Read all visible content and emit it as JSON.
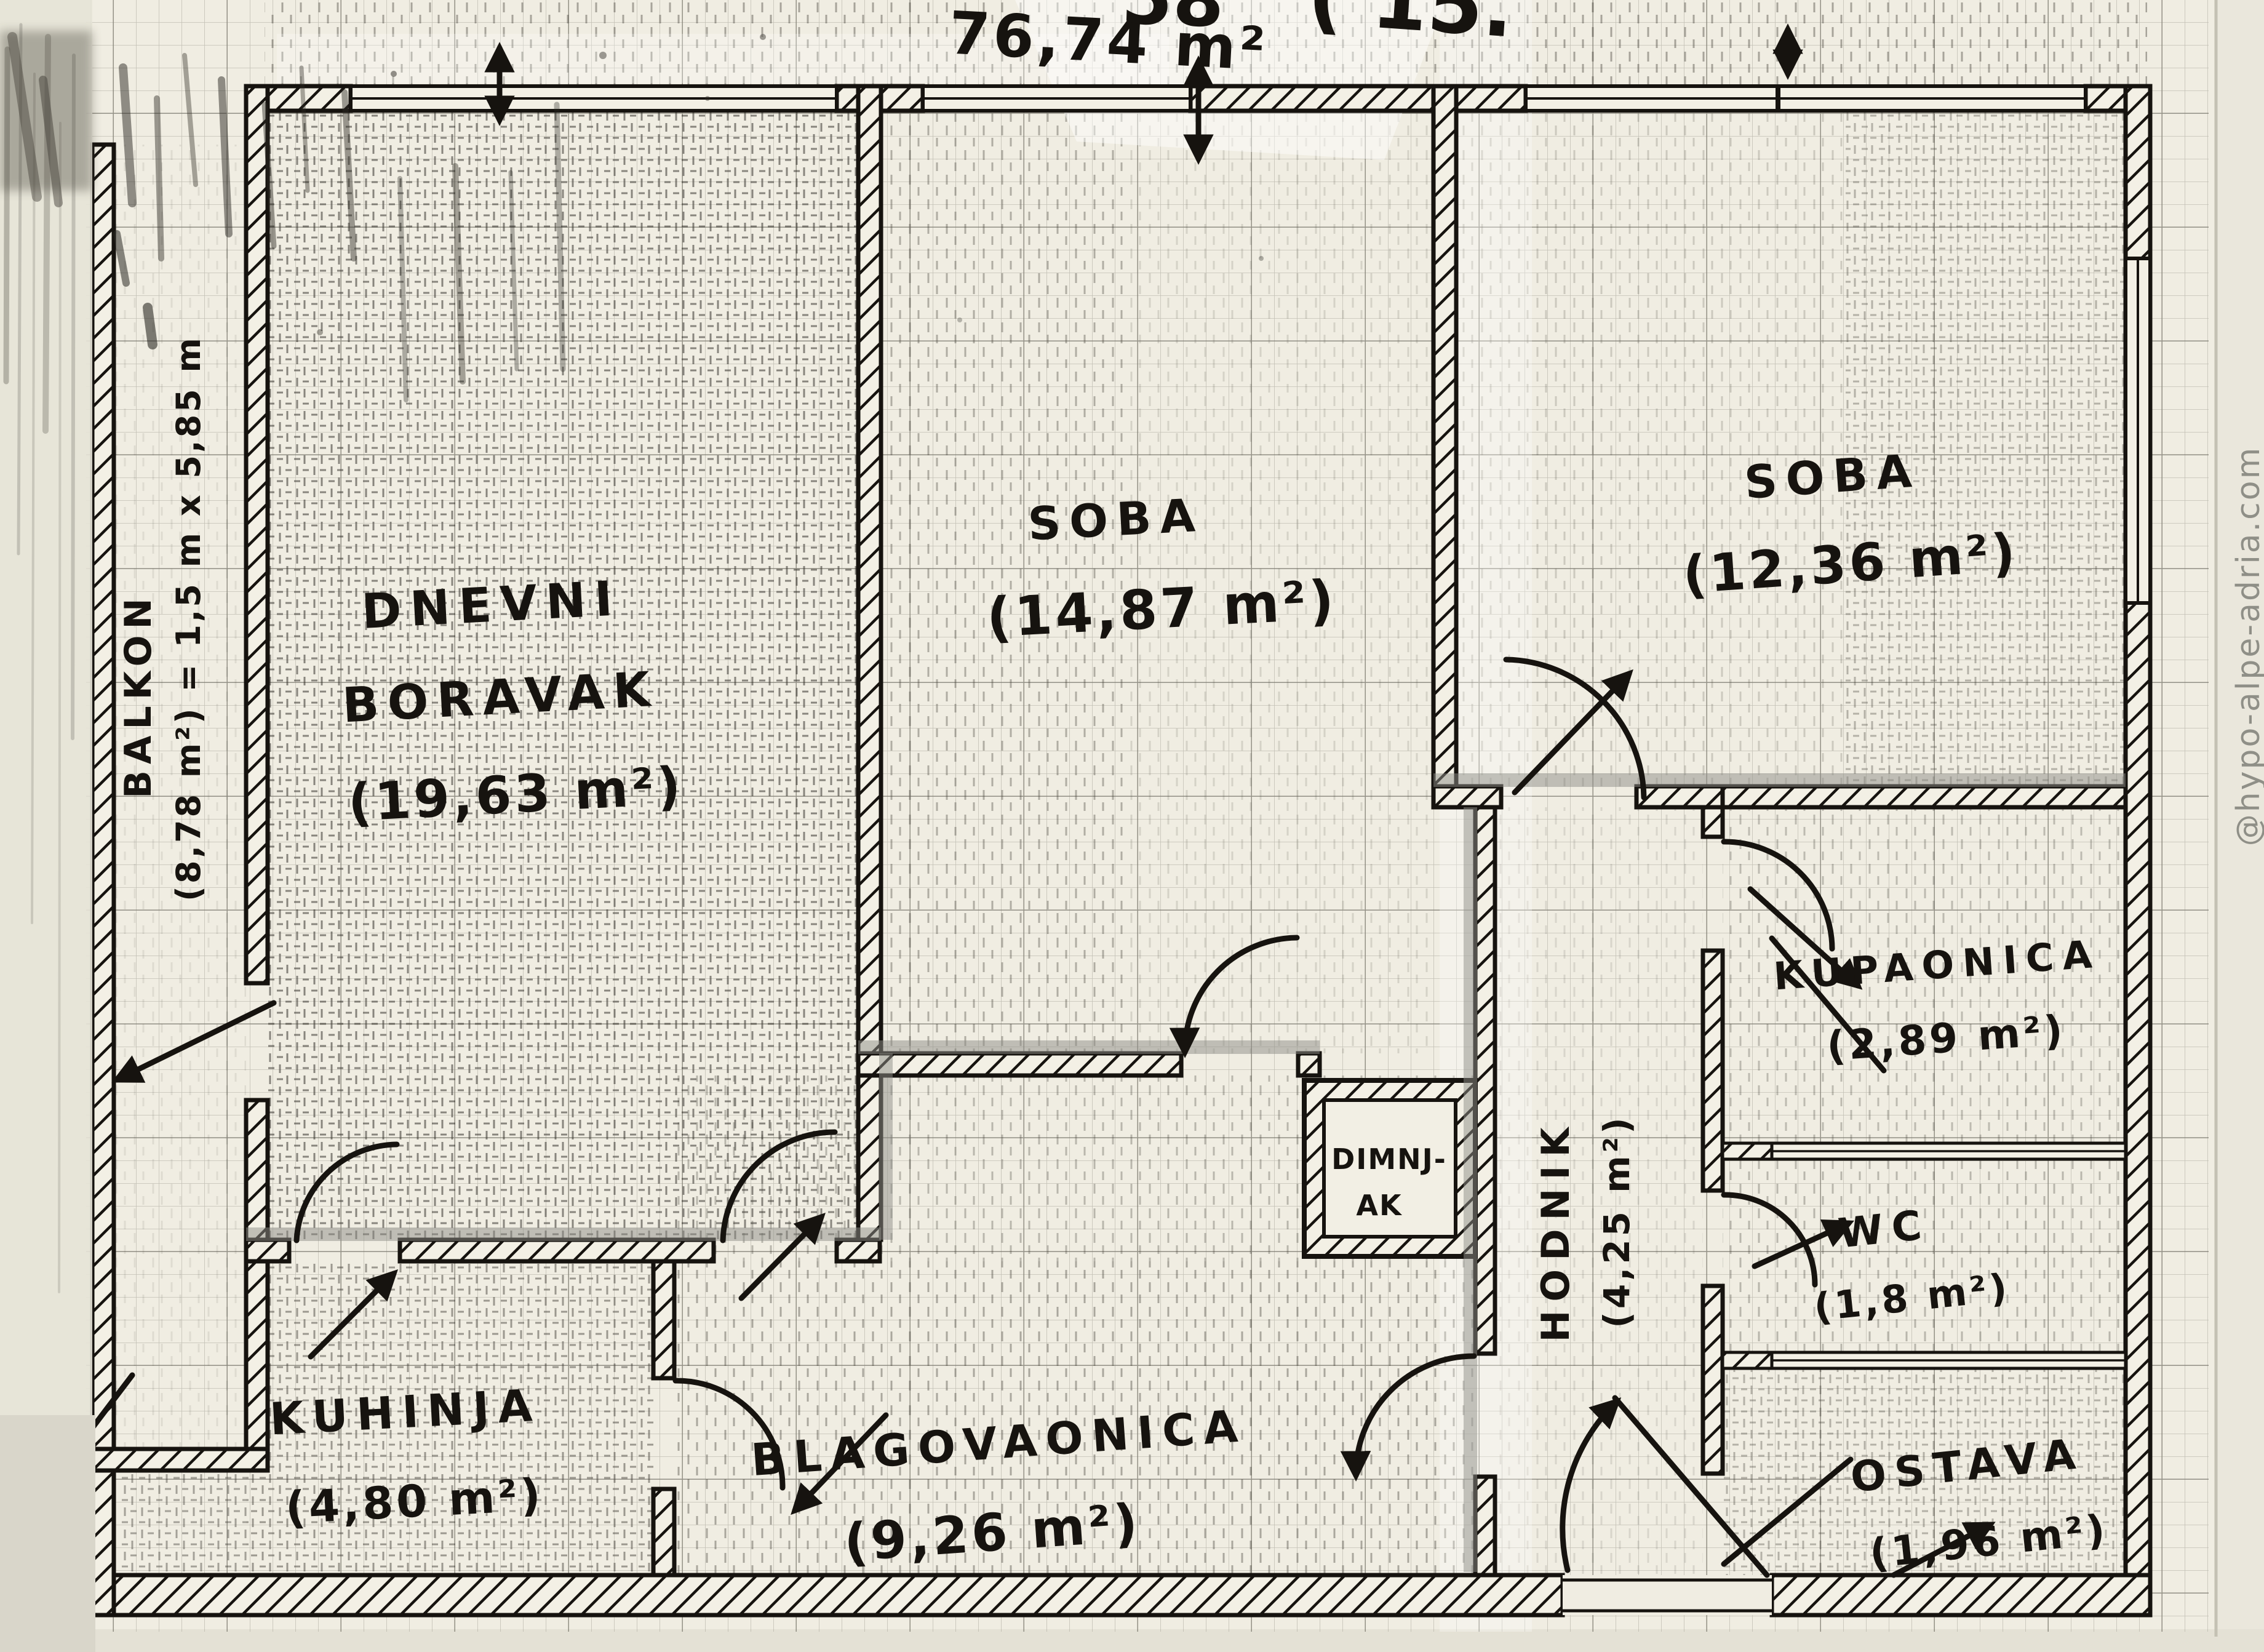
{
  "sheet": {
    "total_area": "76,74 m²",
    "top_fragment_left": "58",
    "top_fragment_right": "( 15.",
    "watermark": "@hypo-alpe-adria.com"
  },
  "rooms": {
    "dnevni_boravak": {
      "line1": "DNEVNI",
      "line2": "BORAVAK",
      "area": "(19,63 m²)"
    },
    "soba1": {
      "name": "SOBA",
      "area": "(14,87 m²)"
    },
    "soba2": {
      "name": "SOBA",
      "area": "(12,36 m²)"
    },
    "kupaonica": {
      "name": "KUPAONICA",
      "area": "(2,89 m²)"
    },
    "wc": {
      "name": "WC",
      "area": "(1,8 m²)"
    },
    "ostava": {
      "name": "OSTAVA",
      "area": "(1,96 m²)"
    },
    "hodnik": {
      "name": "HODNIK",
      "area": "(4,25 m²)"
    },
    "dimnjak": {
      "line1": "DIMNJ-",
      "line2": "AK"
    },
    "kuhinja": {
      "name": "KUHINJA",
      "area": "(4,80 m²)"
    },
    "blagovaonica": {
      "name": "BLAGOVAONICA",
      "area": "(9,26 m²)"
    },
    "balkon": {
      "name": "BALKON",
      "dims": "(8,78 m²) = 1,5 m x 5,85 m"
    }
  },
  "colors": {
    "paper": "#f0ede2",
    "margin": "#e7e4d8",
    "ink": "#16130f",
    "grid_fine": "#9d9c90",
    "grid_bold": "#5f5d52",
    "marker_gray": "#8e8e88",
    "watermark_gray": "#8f8f87"
  }
}
